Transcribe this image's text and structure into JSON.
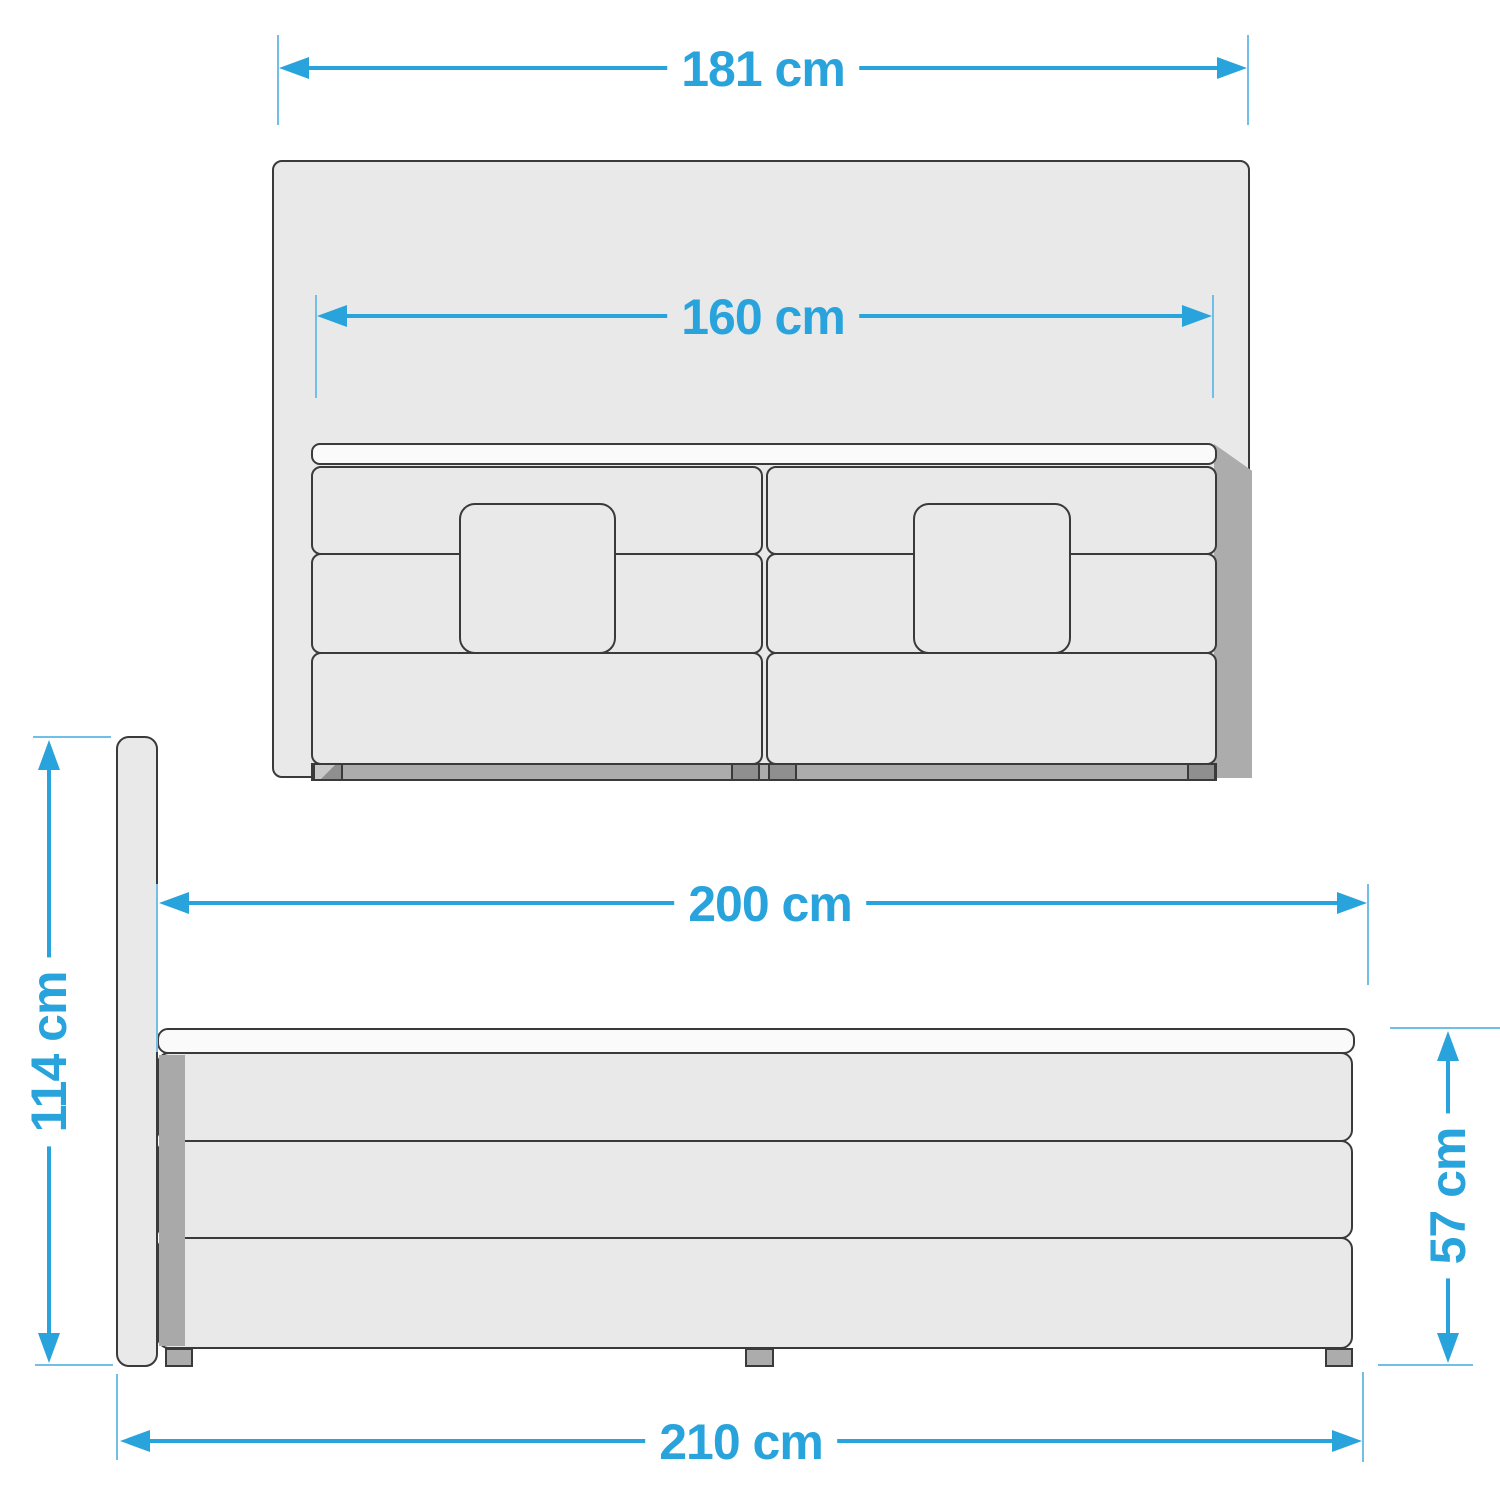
{
  "diagram": {
    "subject": "boxspring-bed-dimension-diagram",
    "views": [
      "front",
      "side"
    ]
  },
  "dimensions": {
    "headboard_width": {
      "label": "181 cm",
      "value_cm": 181
    },
    "mattress_width": {
      "label": "160 cm",
      "value_cm": 160
    },
    "bed_length": {
      "label": "200 cm",
      "value_cm": 200
    },
    "total_height": {
      "label": "114 cm",
      "value_cm": 114
    },
    "base_height": {
      "label": "57 cm",
      "value_cm": 57
    },
    "total_length": {
      "label": "210 cm",
      "value_cm": 210
    }
  },
  "colors": {
    "dimension_blue": "#29A3DC",
    "tick_blue": "#6FBFE6",
    "outline": "#3A3A3A",
    "panel_fill": "#E9E9E9",
    "topper_fill": "#FAFAFA",
    "shadow_gray": "#ACACAC",
    "strip_gray": "#A9A9A9",
    "foot_dark": "#8F8F8F",
    "foot_light": "#C9C9C9"
  }
}
